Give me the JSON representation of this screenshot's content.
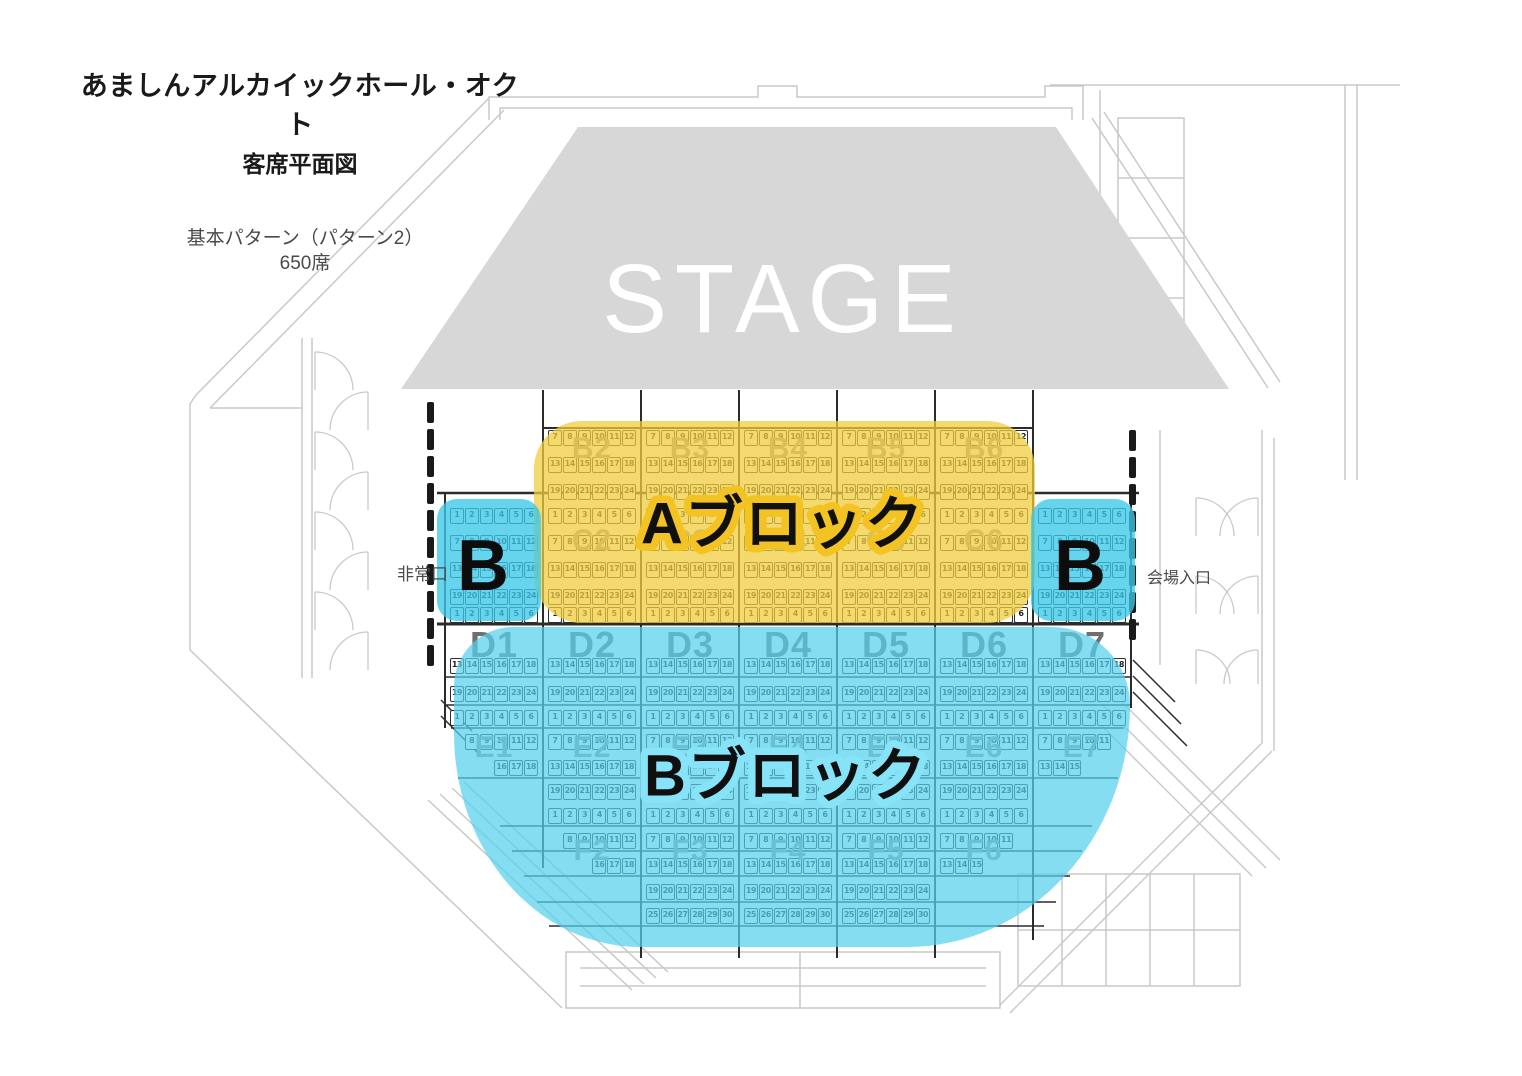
{
  "title": {
    "hall_name": "あましんアルカイックホール・オクト",
    "subtitle": "客席平面図"
  },
  "pattern_note": {
    "line1": "基本パターン（パターン2）",
    "line2": "650席"
  },
  "stage": {
    "label": "STAGE"
  },
  "signs": {
    "emergency_exit": "非常口",
    "venue_entrance": "会場入口"
  },
  "highlights": {
    "a_block": {
      "label": "Aブロック",
      "fill": "rgba(240,206,62,0.75)",
      "stroke": "#F2C322"
    },
    "b_block": {
      "label": "Bブロック",
      "fill": "rgba(85,208,236,0.72)",
      "stroke": "#87E4F8"
    },
    "b_side_left": {
      "label": "B",
      "fill": "rgba(60,200,232,0.78)"
    },
    "b_side_right": {
      "label": "B",
      "fill": "rgba(60,200,232,0.78)"
    }
  },
  "seatmap": {
    "col_left": [
      445,
      543,
      641,
      739,
      837,
      935,
      1033
    ],
    "col_width": 98,
    "box": {
      "inset": 5,
      "slot": 14.8
    },
    "rows": [
      {
        "y": 430,
        "cells": [
          {
            "cols": [
              2,
              3,
              4,
              5,
              6
            ],
            "from": 7,
            "to": 12
          }
        ]
      },
      {
        "y": 457,
        "cells": [
          {
            "cols": [
              2,
              3,
              4,
              5,
              6
            ],
            "from": 13,
            "to": 18
          }
        ]
      },
      {
        "y": 484,
        "cells": [
          {
            "cols": [
              2,
              3,
              4,
              5,
              6
            ],
            "from": 19,
            "to": 24
          }
        ]
      },
      {
        "y": 508,
        "cells": [
          {
            "cols": [
              1,
              2,
              3,
              4,
              5,
              6,
              7
            ],
            "from": 1,
            "to": 6
          }
        ]
      },
      {
        "y": 535,
        "cells": [
          {
            "cols": [
              1,
              2,
              3,
              4,
              5,
              6,
              7
            ],
            "from": 7,
            "to": 12
          }
        ]
      },
      {
        "y": 562,
        "cells": [
          {
            "cols": [
              1,
              2,
              3,
              4,
              5,
              6,
              7
            ],
            "from": 13,
            "to": 18
          }
        ]
      },
      {
        "y": 589,
        "cells": [
          {
            "cols": [
              1,
              2,
              3,
              4,
              5,
              6,
              7
            ],
            "from": 19,
            "to": 24
          }
        ]
      },
      {
        "y": 607,
        "cells": [
          {
            "cols": [
              1,
              2,
              3,
              4,
              5,
              6,
              7
            ],
            "from": 1,
            "to": 6
          }
        ]
      },
      {
        "y": 658,
        "cells": [
          {
            "cols": [
              1,
              2,
              3,
              4,
              5,
              6,
              7
            ],
            "from": 13,
            "to": 18
          }
        ]
      },
      {
        "y": 686,
        "cells": [
          {
            "cols": [
              1,
              2,
              3,
              4,
              5,
              6,
              7
            ],
            "from": 19,
            "to": 24
          }
        ]
      },
      {
        "y": 710,
        "cells": [
          {
            "cols": [
              1,
              2,
              3,
              4,
              5,
              6,
              7
            ],
            "from": 1,
            "to": 6
          }
        ]
      },
      {
        "y": 734,
        "cells": [
          {
            "cols": [
              1
            ],
            "from": 8,
            "to": 12
          },
          {
            "cols": [
              2,
              3,
              4,
              5,
              6
            ],
            "from": 7,
            "to": 12
          },
          {
            "cols": [
              7
            ],
            "from": 7,
            "to": 11
          }
        ]
      },
      {
        "y": 760,
        "cells": [
          {
            "cols": [
              1
            ],
            "from": 16,
            "to": 18
          },
          {
            "cols": [
              2,
              3,
              4,
              5,
              6
            ],
            "from": 13,
            "to": 18
          },
          {
            "cols": [
              7
            ],
            "from": 13,
            "to": 15
          }
        ]
      },
      {
        "y": 784,
        "cells": [
          {
            "cols": [
              2,
              3,
              4,
              5,
              6
            ],
            "from": 19,
            "to": 24
          }
        ]
      },
      {
        "y": 808,
        "cells": [
          {
            "cols": [
              2,
              3,
              4,
              5,
              6
            ],
            "from": 1,
            "to": 6
          }
        ]
      },
      {
        "y": 833,
        "cells": [
          {
            "cols": [
              2
            ],
            "from": 8,
            "to": 12
          },
          {
            "cols": [
              3,
              4,
              5
            ],
            "from": 7,
            "to": 12
          },
          {
            "cols": [
              6
            ],
            "from": 7,
            "to": 11
          }
        ]
      },
      {
        "y": 858,
        "cells": [
          {
            "cols": [
              2
            ],
            "from": 16,
            "to": 18
          },
          {
            "cols": [
              3,
              4,
              5
            ],
            "from": 13,
            "to": 18
          },
          {
            "cols": [
              6
            ],
            "from": 13,
            "to": 15
          }
        ]
      },
      {
        "y": 884,
        "cells": [
          {
            "cols": [
              3,
              4,
              5
            ],
            "from": 19,
            "to": 24
          }
        ]
      },
      {
        "y": 908,
        "cells": [
          {
            "cols": [
              3,
              4,
              5
            ],
            "from": 25,
            "to": 30
          }
        ]
      }
    ],
    "block_labels": [
      {
        "text": "B2",
        "col": 2,
        "y": 449,
        "size": 30
      },
      {
        "text": "B3",
        "col": 3,
        "y": 449,
        "size": 30
      },
      {
        "text": "B4",
        "col": 4,
        "y": 449,
        "size": 30
      },
      {
        "text": "B5",
        "col": 5,
        "y": 449,
        "size": 30
      },
      {
        "text": "B6",
        "col": 6,
        "y": 449,
        "size": 30
      },
      {
        "text": "C2",
        "col": 2,
        "y": 541,
        "size": 30
      },
      {
        "text": "C3",
        "col": 3,
        "y": 541,
        "size": 30
      },
      {
        "text": "C4",
        "col": 4,
        "y": 541,
        "size": 30
      },
      {
        "text": "C5",
        "col": 5,
        "y": 541,
        "size": 30
      },
      {
        "text": "C6",
        "col": 6,
        "y": 541,
        "size": 30
      },
      {
        "text": "D1",
        "col": 1,
        "y": 645,
        "size": 36,
        "color": "#6f6f6f"
      },
      {
        "text": "D2",
        "col": 2,
        "y": 645,
        "size": 36,
        "color": "#6f6f6f"
      },
      {
        "text": "D3",
        "col": 3,
        "y": 645,
        "size": 36,
        "color": "#6f6f6f"
      },
      {
        "text": "D4",
        "col": 4,
        "y": 645,
        "size": 36,
        "color": "#6f6f6f"
      },
      {
        "text": "D5",
        "col": 5,
        "y": 645,
        "size": 36,
        "color": "#6f6f6f"
      },
      {
        "text": "D6",
        "col": 6,
        "y": 645,
        "size": 36,
        "color": "#6f6f6f"
      },
      {
        "text": "D7",
        "col": 7,
        "y": 645,
        "size": 36,
        "color": "#6f6f6f"
      },
      {
        "text": "E1",
        "col": 1,
        "y": 748,
        "size": 30
      },
      {
        "text": "E2",
        "col": 2,
        "y": 748,
        "size": 30
      },
      {
        "text": "E3",
        "col": 3,
        "y": 748,
        "size": 30
      },
      {
        "text": "E4",
        "col": 4,
        "y": 748,
        "size": 30
      },
      {
        "text": "E5",
        "col": 5,
        "y": 748,
        "size": 30
      },
      {
        "text": "E6",
        "col": 6,
        "y": 748,
        "size": 30
      },
      {
        "text": "E7",
        "col": 7,
        "y": 748,
        "size": 30
      },
      {
        "text": "F2",
        "col": 2,
        "y": 851,
        "size": 30
      },
      {
        "text": "F3",
        "col": 3,
        "y": 851,
        "size": 30
      },
      {
        "text": "F4",
        "col": 4,
        "y": 851,
        "size": 30
      },
      {
        "text": "F5",
        "col": 5,
        "y": 851,
        "size": 30
      },
      {
        "text": "F6",
        "col": 6,
        "y": 851,
        "size": 30
      }
    ]
  }
}
